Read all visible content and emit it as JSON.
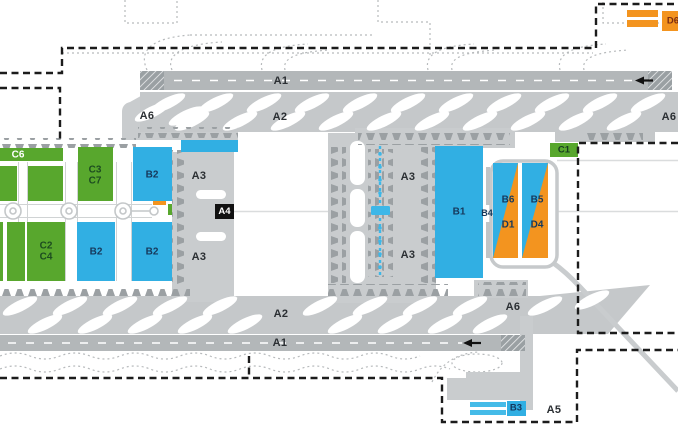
{
  "map_title": "airport-zone-layout",
  "colors": {
    "green": "#58a72d",
    "blue": "#31afe3",
    "bar_blue": "#45bbe8",
    "orange": "#f3941f",
    "apron": "#c9ccce",
    "band": "#c5c8ca",
    "runway": "#b3b7b9",
    "marks": "#9ba0a3",
    "navy": "#16395c",
    "boundary": "#1c1c1c",
    "apm_blue": "#3db7e8"
  },
  "labels": {
    "a1_north": "A1",
    "a1_south": "A1",
    "a2_north": "A2",
    "a2_south": "A2",
    "a3_west_upper": "A3",
    "a3_west_lower": "A3",
    "a3_mid_upper": "A3",
    "a3_mid_lower": "A3",
    "a4": "A4",
    "a5": "A5",
    "a6_northwest": "A6",
    "a6_northeast": "A6",
    "a6_south": "A6",
    "b1": "B1",
    "b2_north": "B2",
    "b2_southwest": "B2",
    "b2_southeast": "B2",
    "b3": "B3",
    "b4": "B4",
    "b5": "B5",
    "b6": "B6",
    "c1": "C1",
    "c6": "C6",
    "d1": "D1",
    "d4": "D4",
    "d6": "D6",
    "c3_c7": {
      "line1": "C3",
      "line2": "C7"
    },
    "c2_c4": {
      "line1": "C2",
      "line2": "C4"
    }
  }
}
